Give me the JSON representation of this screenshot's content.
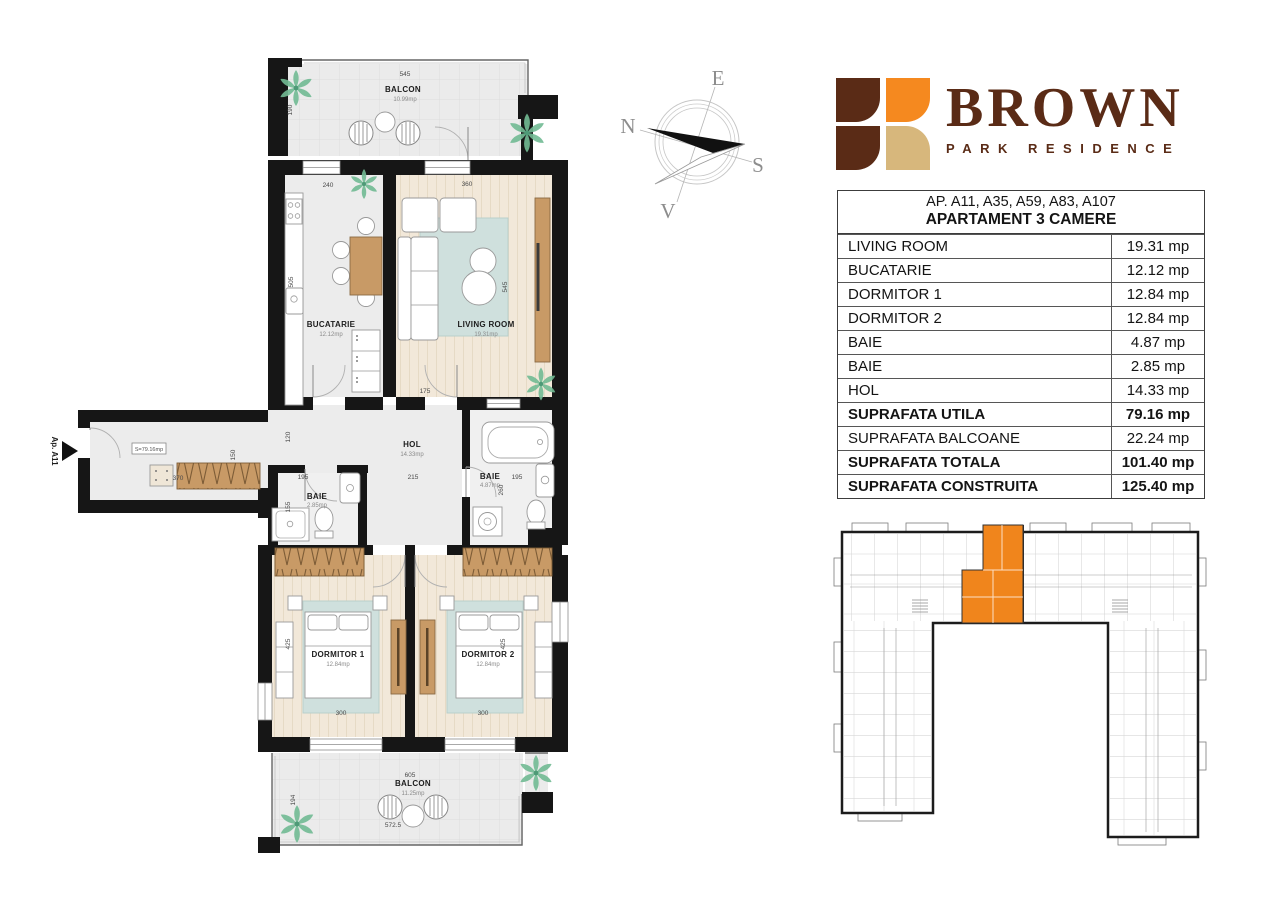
{
  "logo": {
    "title": "BROWN",
    "subtitle": "PARK RESIDENCE"
  },
  "compass": {
    "n": "N",
    "e": "E",
    "s": "S",
    "v": "V"
  },
  "apartment_table": {
    "header_line1": "AP. A11, A35, A59, A83, A107",
    "header_line2": "APARTAMENT 3 CAMERE",
    "rows": [
      {
        "label": "LIVING ROOM",
        "value": "19.31 mp"
      },
      {
        "label": "BUCATARIE",
        "value": "12.12 mp"
      },
      {
        "label": "DORMITOR 1",
        "value": "12.84 mp"
      },
      {
        "label": "DORMITOR 2",
        "value": "12.84 mp"
      },
      {
        "label": "BAIE",
        "value": "4.87 mp"
      },
      {
        "label": "BAIE",
        "value": "2.85 mp"
      },
      {
        "label": "HOL",
        "value": "14.33 mp"
      },
      {
        "label": "SUPRAFATA UTILA",
        "value": "79.16 mp"
      },
      {
        "label": "SUPRAFATA BALCOANE",
        "value": "22.24 mp"
      },
      {
        "label": "SUPRAFATA TOTALA",
        "value": "101.40 mp"
      },
      {
        "label": "SUPRAFATA CONSTRUITA",
        "value": "125.40 mp"
      }
    ]
  },
  "plan": {
    "entry_marker": "Ap. A11",
    "area_total_label": "S=79.16mp",
    "rooms": {
      "balcon_top": {
        "name": "BALCON",
        "area": "10.99mp"
      },
      "bucatarie": {
        "name": "BUCATARIE",
        "area": "12.12mp"
      },
      "living": {
        "name": "LIVING ROOM",
        "area": "19.31mp"
      },
      "hol": {
        "name": "HOL",
        "area": "14.33mp"
      },
      "baie_mica": {
        "name": "BAIE",
        "area": "2.85mp"
      },
      "baie_mare": {
        "name": "BAIE",
        "area": "4.87mp"
      },
      "dormitor1": {
        "name": "DORMITOR 1",
        "area": "12.84mp"
      },
      "dormitor2": {
        "name": "DORMITOR 2",
        "area": "12.84mp"
      },
      "balcon_jos": {
        "name": "BALCON",
        "area": "11.25mp"
      }
    },
    "dims": {
      "balcon_top_w": "545",
      "balcon_top_h": "190",
      "bucatarie_w": "240",
      "living_w": "360",
      "bucatarie_h": "505",
      "living_h": "545",
      "hol_top": "175",
      "hol_left": "120",
      "hall_h": "150",
      "hall_w": "370",
      "hol_w": "215",
      "baie_mica_w": "195",
      "baie_mica_h": "155",
      "baie_mare_w": "195",
      "baie_mare_h": "260",
      "dormitor1_h": "425",
      "dormitor1_w": "300",
      "dormitor2_h": "425",
      "dormitor2_w": "300",
      "balcon_jos_w": "605",
      "balcon_jos_h": "194",
      "balcon_jos_w2": "572.5"
    }
  },
  "colors": {
    "brand_brown": "#5a2b16",
    "brand_orange": "#f5891f",
    "brand_tan": "#d7b77c",
    "keyplan_highlight": "#f0851c",
    "wall": "#161616",
    "wood_floor": "#f2e8d9",
    "rug": "#cfe0dd",
    "furniture_wood": "#c89a66"
  }
}
